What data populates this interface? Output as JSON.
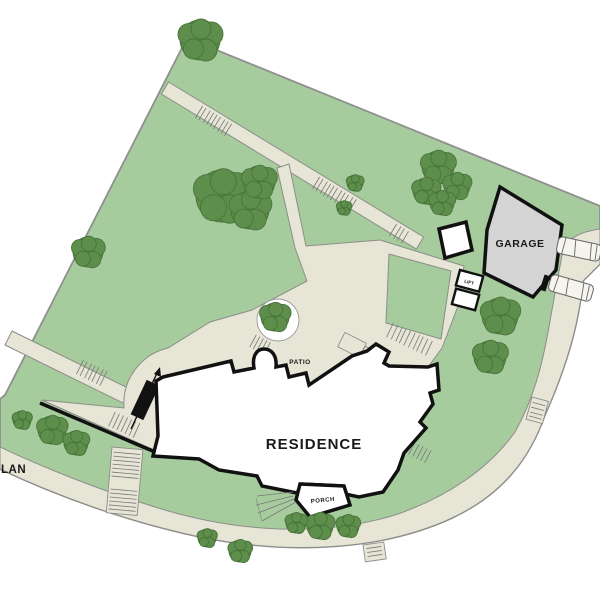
{
  "plan": {
    "type": "site-plan",
    "labels": {
      "garage": "GARAGE",
      "residence": "RESIDENCE",
      "patio": "PATIO",
      "porch": "PORCH",
      "lift": "LIFT",
      "plan_title_partial": "LAN"
    },
    "colors": {
      "lawn": "#a6cc9e",
      "tree": "#5e8e4b",
      "tree_edge": "#48743a",
      "path": "#e6e5d6",
      "path_stroke": "#8d8d89",
      "boundary": "#8f8f8f",
      "building_fill": "#ffffff",
      "building_stroke": "#111111",
      "garage_fill": "#d4d4d4",
      "background": "#ffffff"
    },
    "features": {
      "buildings": [
        "residence",
        "garage",
        "outbuilding",
        "lift-shaft"
      ],
      "car_count": 2,
      "stair_runs": 9
    },
    "trees": [
      {
        "x": 200,
        "y": 40,
        "r": 20
      },
      {
        "x": 88,
        "y": 252,
        "r": 15
      },
      {
        "x": 222,
        "y": 196,
        "r": 26
      },
      {
        "x": 250,
        "y": 210,
        "r": 19
      },
      {
        "x": 259,
        "y": 182,
        "r": 16
      },
      {
        "x": 355,
        "y": 183,
        "r": 8
      },
      {
        "x": 344,
        "y": 208,
        "r": 7
      },
      {
        "x": 438,
        "y": 167,
        "r": 16
      },
      {
        "x": 457,
        "y": 186,
        "r": 13
      },
      {
        "x": 426,
        "y": 191,
        "r": 13
      },
      {
        "x": 442,
        "y": 203,
        "r": 12
      },
      {
        "x": 500,
        "y": 316,
        "r": 18
      },
      {
        "x": 490,
        "y": 357,
        "r": 16
      },
      {
        "x": 275,
        "y": 317,
        "r": 14
      },
      {
        "x": 22,
        "y": 420,
        "r": 9
      },
      {
        "x": 52,
        "y": 430,
        "r": 14
      },
      {
        "x": 76,
        "y": 443,
        "r": 12
      },
      {
        "x": 320,
        "y": 526,
        "r": 13
      },
      {
        "x": 348,
        "y": 526,
        "r": 11
      },
      {
        "x": 296,
        "y": 523,
        "r": 10
      },
      {
        "x": 240,
        "y": 551,
        "r": 11
      },
      {
        "x": 207,
        "y": 538,
        "r": 9
      }
    ],
    "cars": [
      {
        "x": 579,
        "y": 249,
        "angle": 12
      },
      {
        "x": 571,
        "y": 288,
        "angle": 16
      }
    ]
  }
}
